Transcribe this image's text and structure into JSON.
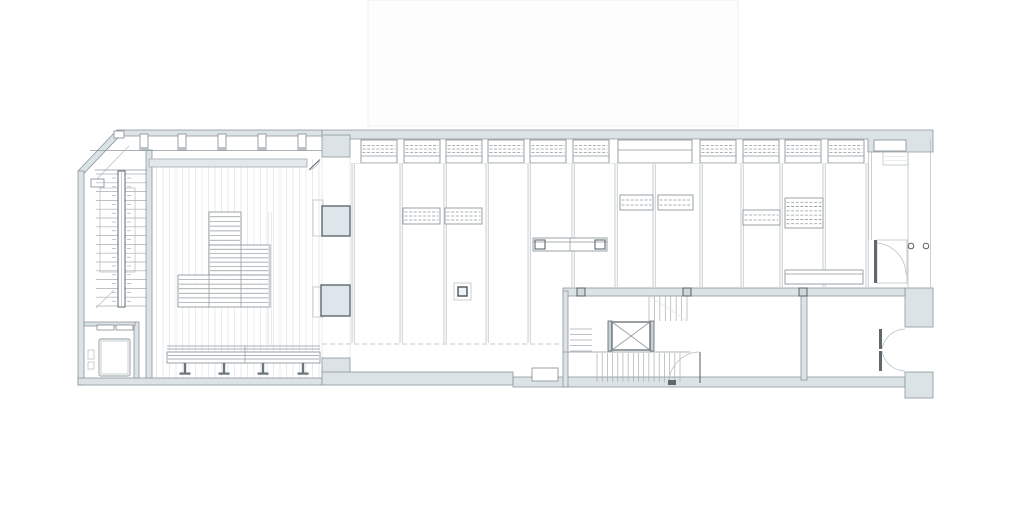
{
  "document": {
    "kind": "architectural-floor-plan",
    "visible_text": "none (only illegible stair step-number ticks)",
    "rooms": {
      "left_hall": "event-space-with-plank-floor-and-tiered-seating",
      "left_stair": "u-shaped-stair-with-center-stringer",
      "service_room": "small-room-bottom-left-with-equipment",
      "main_hall": "shelving-hall-with-perimeter-shelves-and-rails",
      "core": "stair-and-elevator-core",
      "back_room": "rear-room-bottom-right",
      "vestibule": "entrance-vestibule-right-with-double-doors"
    }
  },
  "colors": {
    "paper": "#ffffff",
    "wallFill": "#dce3e6",
    "wallStroke": "#8e979c",
    "mid": "#8f989c",
    "dark": "#5f686c",
    "thin": "#b4bbbf",
    "faint": "#dfe3e5",
    "plank": "#e6e9eb",
    "tread": "#a7aeb2",
    "colFill": "#dde6ea",
    "roofFill": "#fdfdfd",
    "roofStroke": "#eef0f1",
    "ledgeFill": "#e2e9ec"
  },
  "plan": {
    "upper_volume": {
      "x": 368,
      "y": 0,
      "w": 370,
      "h": 126
    },
    "pilasters": {
      "xs": [
        140,
        178,
        218,
        258,
        298
      ],
      "y": 134,
      "w": 8,
      "h": 16
    },
    "top_shelves": {
      "xs": [
        361,
        404,
        446,
        488,
        530,
        573,
        700,
        743,
        785,
        828
      ],
      "y": 140,
      "w": 36,
      "h": 23
    },
    "counter": {
      "x": 618,
      "y": 140,
      "w": 74,
      "h": 23
    },
    "wall_niche": {
      "x": 874,
      "y": 140,
      "w": 32,
      "h": 11
    },
    "rails_left": {
      "xs": [
        352,
        400,
        444,
        486,
        528
      ],
      "y1": 163,
      "y2": 343
    },
    "rails_right": {
      "xs": [
        572,
        615,
        653,
        700,
        741,
        780,
        823,
        866
      ],
      "y1": 163,
      "y2": 287
    },
    "mid_shelves": [
      {
        "x": 403,
        "y": 208,
        "w": 37,
        "h": 16
      },
      {
        "x": 445,
        "y": 208,
        "w": 37,
        "h": 16
      },
      {
        "x": 620,
        "y": 195,
        "w": 33,
        "h": 15
      },
      {
        "x": 658,
        "y": 195,
        "w": 35,
        "h": 15
      },
      {
        "x": 743,
        "y": 210,
        "w": 37,
        "h": 15
      },
      {
        "x": 785,
        "y": 198,
        "w": 38,
        "h": 30
      },
      {
        "x": 883,
        "y": 152,
        "w": 25,
        "h": 13,
        "faint": true
      }
    ],
    "seating_tiers": [
      {
        "x": 209,
        "y": 212,
        "w": 32,
        "h": 33
      },
      {
        "x": 209,
        "y": 245,
        "w": 61,
        "h": 30
      },
      {
        "x": 178,
        "y": 275,
        "w": 92,
        "h": 32
      }
    ],
    "bench": {
      "x1": 167,
      "x2": 320,
      "back_y": 346,
      "seat_y": 352,
      "seat_h": 11,
      "leg_xs": [
        185,
        224,
        263,
        303
      ]
    },
    "table": {
      "x": 533,
      "y": 238,
      "w": 74,
      "h": 13
    },
    "desk": {
      "x": 785,
      "y": 270,
      "w": 78,
      "h": 14
    },
    "column_box": {
      "x": 454,
      "y": 283,
      "w": 17,
      "h": 17
    },
    "columns": [
      {
        "x": 322,
        "y": 206,
        "w": 28,
        "h": 30
      },
      {
        "x": 321,
        "y": 285,
        "w": 29,
        "h": 31
      }
    ],
    "column_ghosts": [
      {
        "x": 313,
        "y": 200,
        "w": 10,
        "h": 36
      },
      {
        "x": 313,
        "y": 287,
        "w": 10,
        "h": 30
      }
    ],
    "stair_left": {
      "x1": 96,
      "x2": 147,
      "y1": 174,
      "y2": 306,
      "steps": 16,
      "stringer": {
        "x": 118,
        "y": 171,
        "w": 7,
        "h": 136
      }
    },
    "core": {
      "elevator": {
        "x": 612,
        "y": 322,
        "w": 38,
        "h": 28
      },
      "upper_flight": {
        "x1": 649,
        "x2": 687,
        "y1": 296,
        "y2": 321,
        "steps": 8
      },
      "side_flight": {
        "y1": 329,
        "y2": 351,
        "x1": 570,
        "x2": 592,
        "steps": 5
      },
      "lower_flight": {
        "x1": 597,
        "x2": 680,
        "y1": 353,
        "y2": 382,
        "steps": 17
      },
      "landing_y": 352
    },
    "wall_track_squares": {
      "xs": [
        577,
        683,
        799
      ],
      "y": 288,
      "size": 8
    },
    "entry_circles": [
      {
        "cx": 911,
        "cy": 246,
        "r": 2.8
      },
      {
        "cx": 926,
        "cy": 246,
        "r": 2.8
      }
    ],
    "bottom_niche": {
      "x": 532,
      "y": 368,
      "w": 26,
      "h": 13
    },
    "ledge": {
      "x": 149,
      "y": 159,
      "w": 158,
      "h": 8
    },
    "dashed_line": {
      "x1": 322,
      "x2": 563,
      "y": 344
    },
    "platform_edge": {
      "x": 268.5,
      "y1": 212,
      "y2": 345
    }
  }
}
